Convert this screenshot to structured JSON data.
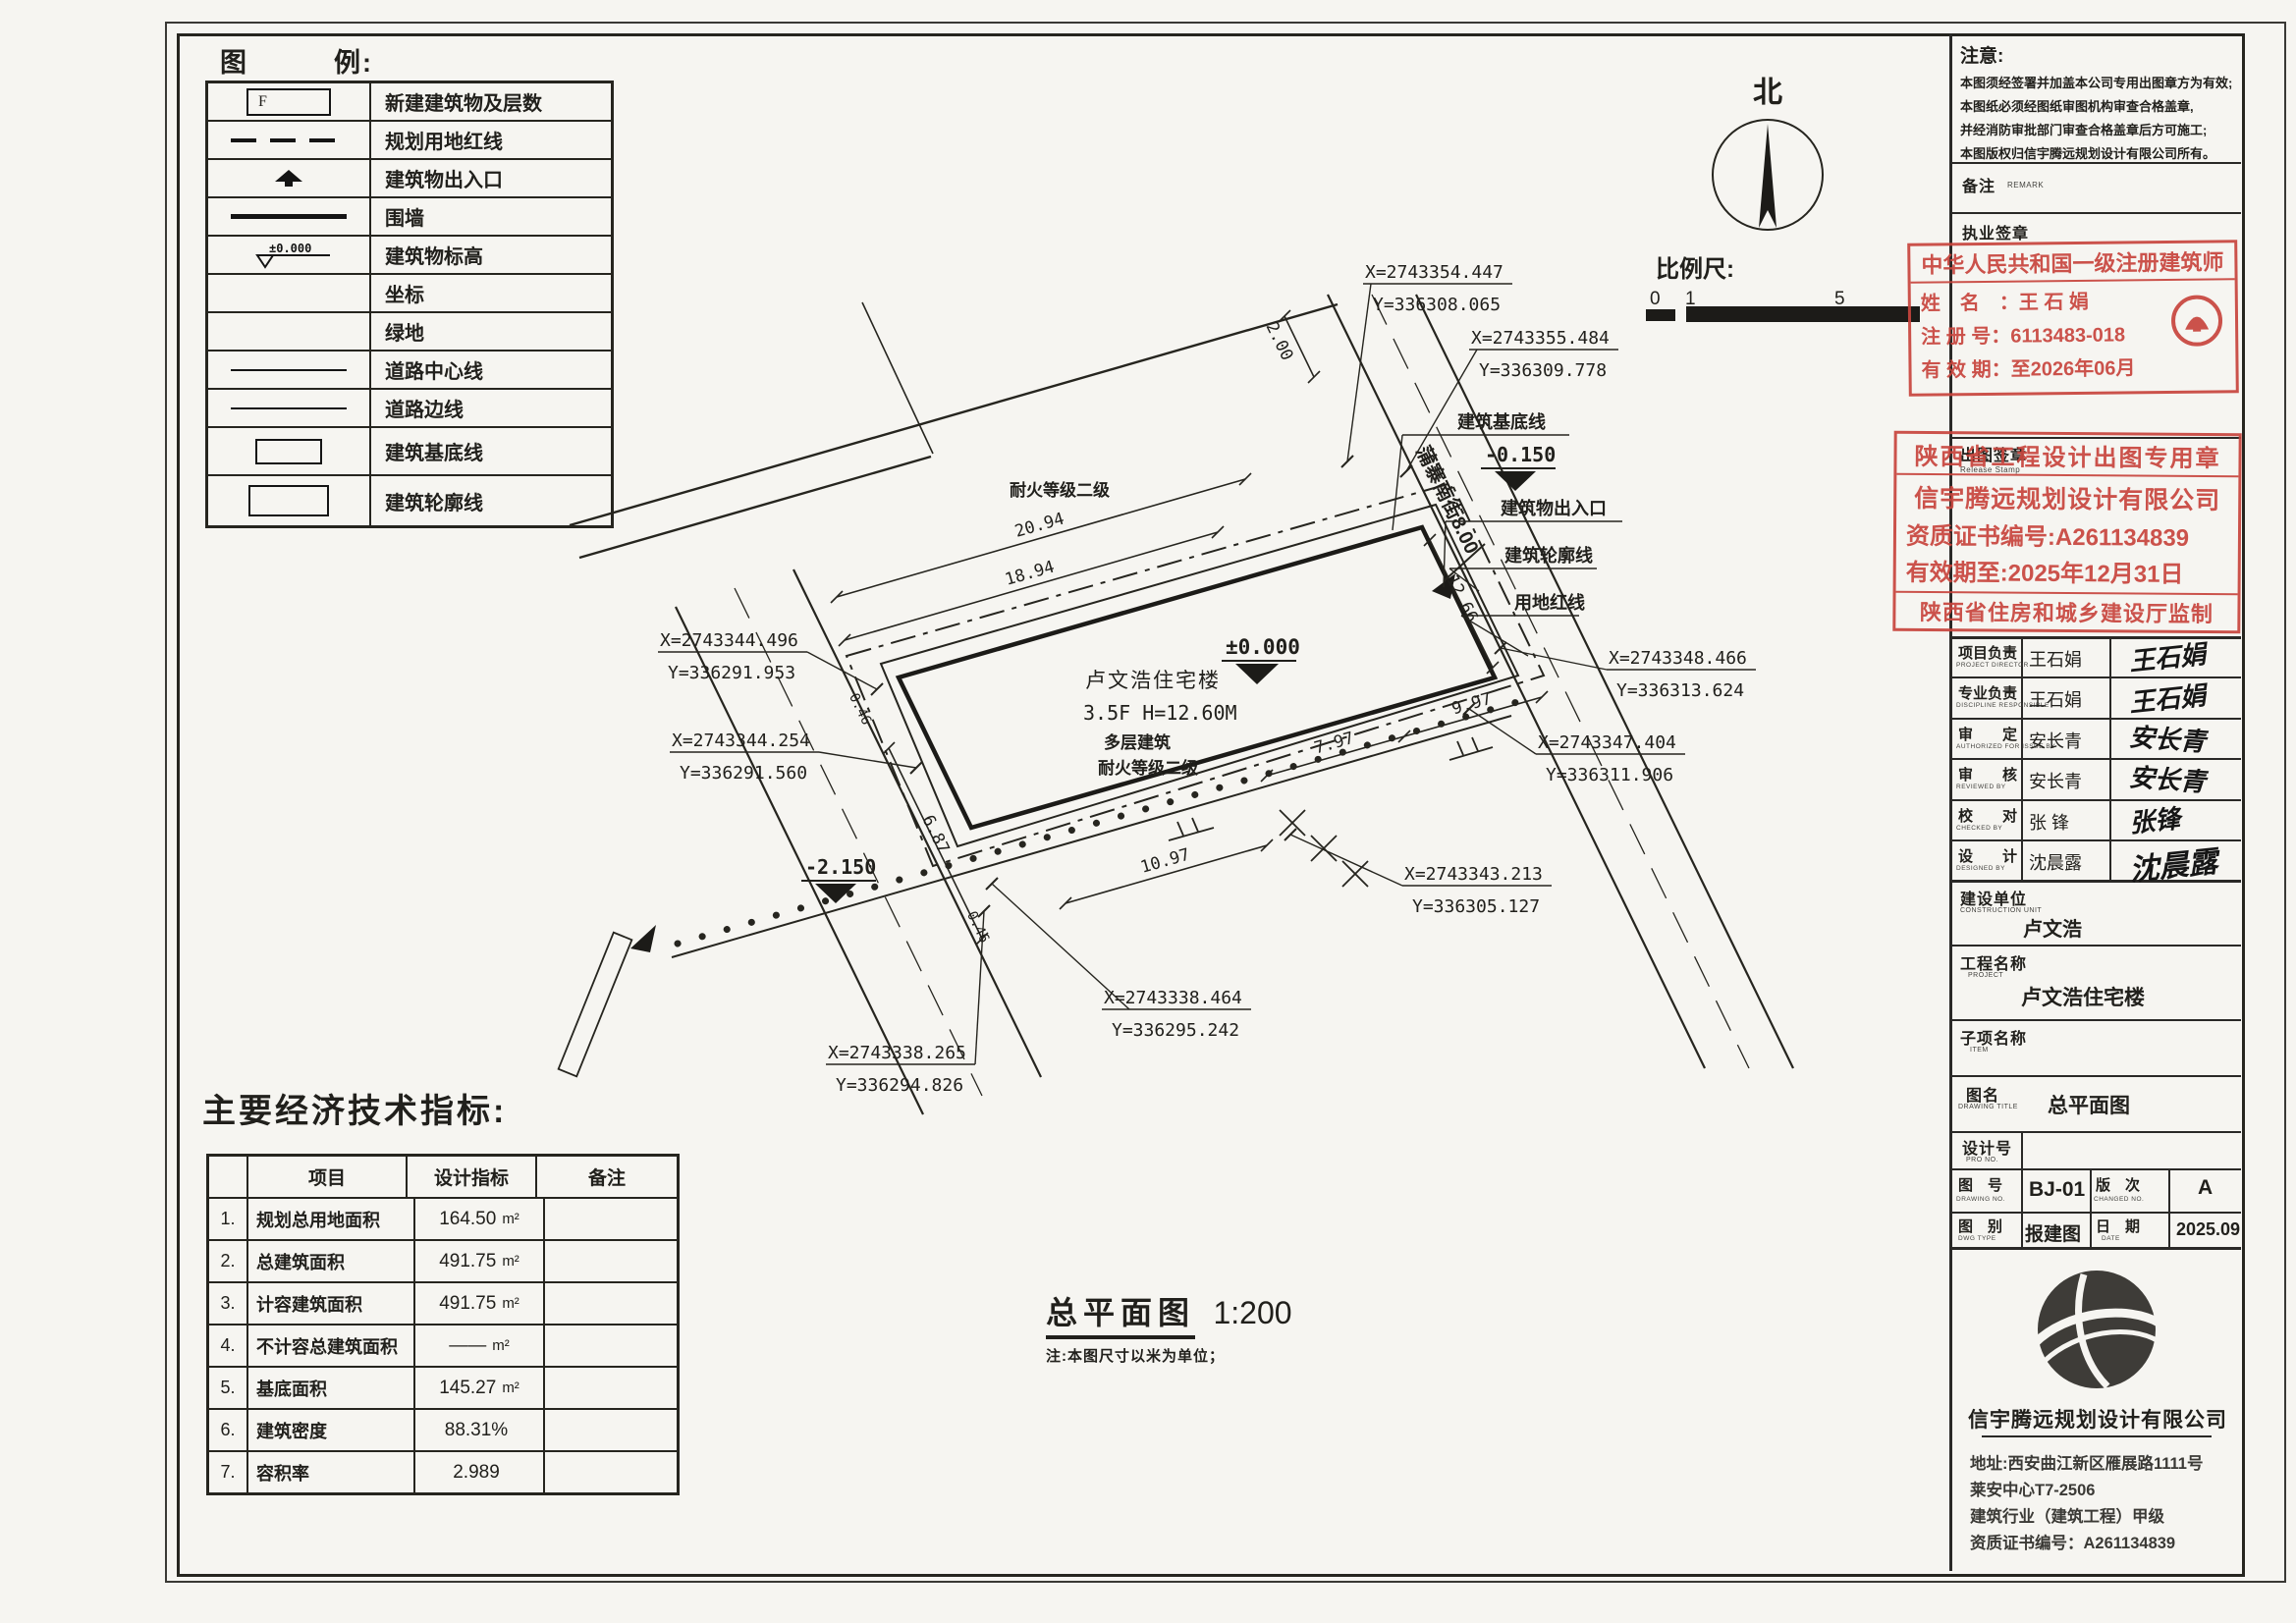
{
  "colors": {
    "paper": "#f6f5f1",
    "ink": "#21201c",
    "stamp_red": "#c8453d"
  },
  "legend": {
    "title": "图　　　例:",
    "rows": [
      {
        "symbol": "new-building-box",
        "symbol_text": "F",
        "label": "新建建筑物及层数"
      },
      {
        "symbol": "dashed-line",
        "label": "规划用地红线"
      },
      {
        "symbol": "entrance-arrow",
        "label": "建筑物出入口"
      },
      {
        "symbol": "thick-line",
        "label": "围墙"
      },
      {
        "symbol": "elevation-mark",
        "symbol_text": "±0.000",
        "label": "建筑物标高"
      },
      {
        "symbol": "none",
        "label": "坐标"
      },
      {
        "symbol": "none",
        "label": "绿地"
      },
      {
        "symbol": "thin-line",
        "label": "道路中心线"
      },
      {
        "symbol": "thin-line",
        "label": "道路边线"
      },
      {
        "symbol": "small-rect",
        "label": "建筑基底线"
      },
      {
        "symbol": "large-rect",
        "label": "建筑轮廓线"
      }
    ]
  },
  "north": {
    "label": "北"
  },
  "scalebar": {
    "label": "比例尺:",
    "t0": "0",
    "t1": "1",
    "t5": "5"
  },
  "plan": {
    "building": {
      "line1": "卢文浩住宅楼",
      "line2": "3.5F H=12.60M",
      "line3": "多层建筑",
      "line4": "耐火等级二级"
    },
    "neighbor_label": "耐火等级二级",
    "road_label": "蒲寨南街8.00",
    "elev": {
      "zero": "±0.000",
      "m015": "-0.150",
      "m215": "-2.150"
    },
    "dims": {
      "d1": "20.94",
      "d2": "18.94",
      "d3": "2.00",
      "d4": "12.66",
      "d5": "7.97",
      "d6": "9.97",
      "d7": "10.97",
      "d8": "6.87",
      "d9": "0.46",
      "d10": "0.46"
    },
    "features": {
      "f1": "建筑基底线",
      "f2": "建筑物出入口",
      "f3": "建筑轮廓线",
      "f4": "用地红线"
    },
    "callouts": [
      {
        "x": "X=2743354.447",
        "y": "Y=336308.065"
      },
      {
        "x": "X=2743355.484",
        "y": "Y=336309.778"
      },
      {
        "x": "X=2743348.466",
        "y": "Y=336313.624"
      },
      {
        "x": "X=2743347.404",
        "y": "Y=336311.906"
      },
      {
        "x": "X=2743343.213",
        "y": "Y=336305.127"
      },
      {
        "x": "X=2743338.464",
        "y": "Y=336295.242"
      },
      {
        "x": "X=2743338.265",
        "y": "Y=336294.826"
      },
      {
        "x": "X=2743344.496",
        "y": "Y=336291.953"
      },
      {
        "x": "X=2743344.254",
        "y": "Y=336291.560"
      }
    ],
    "caption": {
      "title": "总平面图",
      "scale": "1:200",
      "note": "注:本图尺寸以米为单位；"
    }
  },
  "econ": {
    "title": "主要经济技术指标:",
    "headers": {
      "item": "项目",
      "value": "设计指标",
      "remark": "备注"
    },
    "rows": [
      {
        "no": "1.",
        "item": "规划总用地面积",
        "value": "164.50",
        "unit": "m²"
      },
      {
        "no": "2.",
        "item": "总建筑面积",
        "value": "491.75",
        "unit": "m²"
      },
      {
        "no": "3.",
        "item": "计容建筑面积",
        "value": "491.75",
        "unit": "m²"
      },
      {
        "no": "4.",
        "item": "不计容总建筑面积",
        "value": "——",
        "unit": "m²"
      },
      {
        "no": "5.",
        "item": "基底面积",
        "value": "145.27",
        "unit": "m²"
      },
      {
        "no": "6.",
        "item": "建筑密度",
        "value": "88.31%",
        "unit": ""
      },
      {
        "no": "7.",
        "item": "容积率",
        "value": "2.989",
        "unit": ""
      }
    ]
  },
  "titleblock": {
    "notes": {
      "title": "注意:",
      "lines": [
        "本图须经签署并加盖本公司专用出图章方为有效;",
        "本图纸必须经图纸审图机构审查合格盖章,",
        "并经消防审批部门审查合格盖章后方可施工;",
        "本图版权归信宇腾远规划设计有限公司所有。"
      ]
    },
    "remark": {
      "label": "备注",
      "sub": "REMARK"
    },
    "practice_seal_label": "执业签章",
    "stamp1": {
      "title": "中华人民共和国一级注册建筑师",
      "rows": [
        {
          "label": "姓　名　：",
          "value": "王 石 娟"
        },
        {
          "label": "注 册 号：",
          "value": "6113483-018"
        },
        {
          "label": "有 效 期：",
          "value": "至2026年06月"
        }
      ]
    },
    "release_seal": {
      "label": "出图签章",
      "sub": "Release Stamp"
    },
    "stamp2": {
      "line1": "陕西省工程设计出图专用章",
      "line2": "信宇腾远规划设计有限公司",
      "line3": "资质证书编号:A261134839",
      "line4": "有效期至:2025年12月31日",
      "line5": "陕西省住房和城乡建设厅监制"
    },
    "roles": [
      {
        "label": "项目负责",
        "sub": "PROJECT DIRECTOR",
        "name": "王石娟",
        "sig": "王石娟"
      },
      {
        "label": "专业负责",
        "sub": "DISCIPLINE RESPONSIBLE",
        "name": "王石娟",
        "sig": "王石娟"
      },
      {
        "label": "审　　定",
        "sub": "AUTHORIZED FOR ISSUE BY",
        "name": "安长青",
        "sig": "安长青"
      },
      {
        "label": "审　　核",
        "sub": "REVIEWED BY",
        "name": "安长青",
        "sig": "安长青"
      },
      {
        "label": "校　　对",
        "sub": "CHECKED BY",
        "name": "张 锋",
        "sig": "张锋"
      },
      {
        "label": "设　　计",
        "sub": "DESIGNED BY",
        "name": "沈晨露",
        "sig": "沈晨露"
      }
    ],
    "info": [
      {
        "label": "建设单位",
        "sub": "CONSTRUCTION UNIT",
        "value": "卢文浩"
      },
      {
        "label": "工程名称",
        "sub": "PROJECT",
        "value": "卢文浩住宅楼"
      },
      {
        "label": "子项名称",
        "sub": "ITEM",
        "value": ""
      },
      {
        "label": "图名",
        "sub": "DRAWING TITLE",
        "value": "总平面图"
      },
      {
        "label": "设计号",
        "sub": "PRO NO.",
        "value": ""
      }
    ],
    "grid": {
      "no_label": "图　号",
      "no_sub": "DRAWING NO.",
      "no_value": "BJ-01",
      "rev_label": "版　次",
      "rev_sub": "CHANGED NO.",
      "rev_value": "A",
      "type_label": "图　别",
      "type_sub": "DWG TYPE",
      "type_value": "报建图",
      "date_label": "日　期",
      "date_sub": "DATE",
      "date_value": "2025.09"
    },
    "company": {
      "name": "信宇腾远规划设计有限公司",
      "line1": "地址:西安曲江新区雁展路1111号",
      "line2": "莱安中心T7-2506",
      "line3": "建筑行业（建筑工程）甲级",
      "line4": "资质证书编号：A261134839"
    }
  }
}
